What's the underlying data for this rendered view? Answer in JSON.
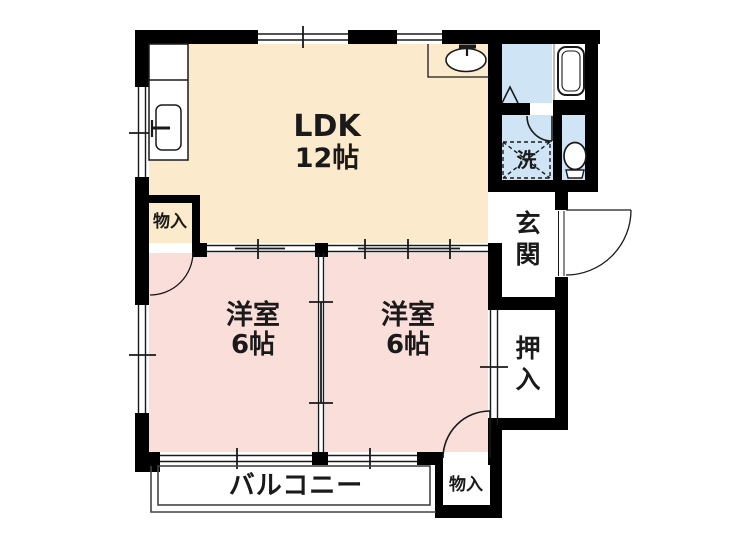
{
  "rooms": {
    "ldk": {
      "label": "LDK",
      "size": "12帖"
    },
    "bedroom_left": {
      "label": "洋室",
      "size": "6帖"
    },
    "bedroom_right": {
      "label": "洋室",
      "size": "6帖"
    },
    "entrance": {
      "label": "玄関"
    },
    "closet": {
      "label": "押入"
    },
    "storage_upper_left": {
      "label": "物入"
    },
    "storage_lower_right": {
      "label": "物入"
    },
    "balcony": {
      "label": "バルコニー"
    },
    "laundry_space": {
      "label": "洗"
    }
  },
  "fixtures": [
    "kitchen-sink",
    "washbasin",
    "bathtub",
    "toilet",
    "washing-machine-space"
  ],
  "colors": {
    "ldk_floor": "#fbeacb",
    "bedroom_floor": "#f9deda",
    "wet_area_floor": "#cfe4f4",
    "wall": "#000000",
    "line": "#1a1a1a",
    "background": "#ffffff"
  }
}
